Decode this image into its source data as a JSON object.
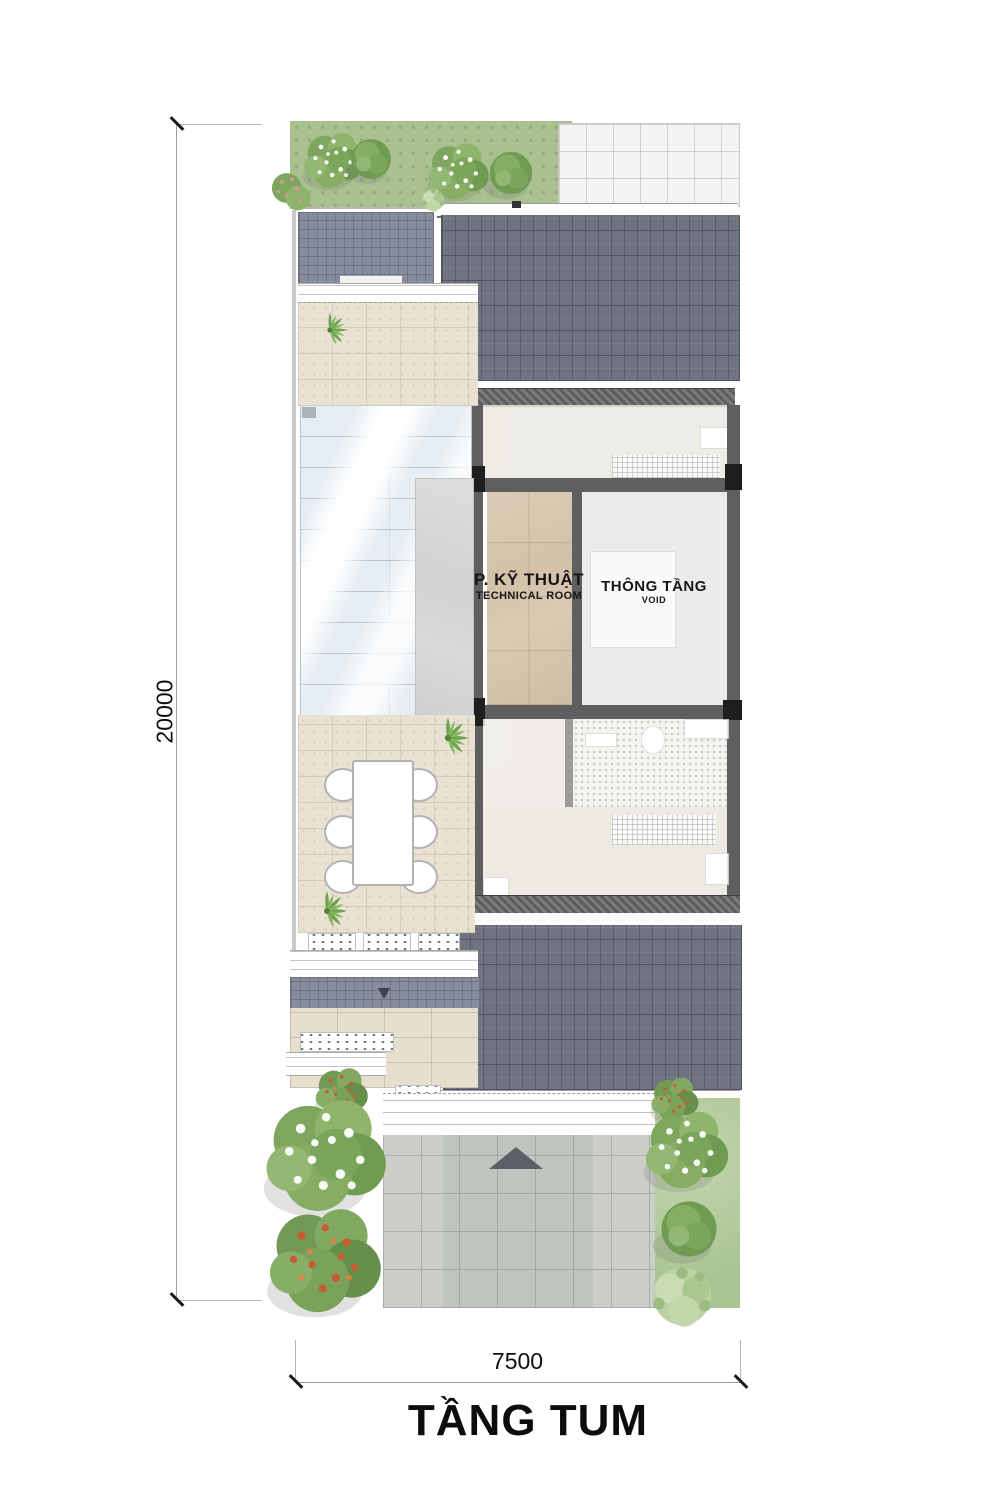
{
  "drawing": {
    "title": "TẦNG TUM",
    "dim_vertical": "20000",
    "dim_horizontal": "7500",
    "rooms": {
      "technical": {
        "name": "P. KỸ THUẬT",
        "subtitle": "TECHNICAL ROOM"
      },
      "void": {
        "name": "THÔNG TẦNG",
        "subtitle": "VOID"
      }
    },
    "colors": {
      "roof_dark": "#6f7480",
      "roof_light": "#878d9c",
      "wall": "#5f5f5f",
      "column": "#1e1e1e",
      "terrace": "#e9e2d3",
      "marble": "#d8c6b0",
      "void_floor": "#ebebe9",
      "skylight": "#e7eef3",
      "garden": "#a9c18f",
      "driveway": "#cbcec9",
      "tile_white": "#f3f3f1"
    }
  }
}
